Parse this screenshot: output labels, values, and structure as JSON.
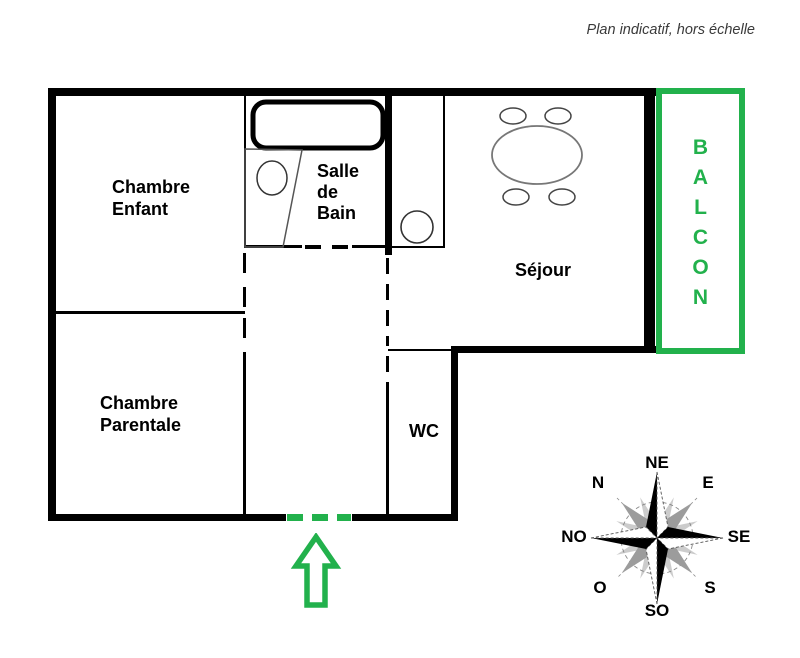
{
  "title": "Plan indicatif, hors échelle",
  "rooms": {
    "chambre_enfant": "Chambre\nEnfant",
    "chambre_parentale": "Chambre\nParentale",
    "salle_de_bain": "Salle\nde\nBain",
    "sejour": "Séjour",
    "wc": "WC"
  },
  "balcony": {
    "name": "BALCON",
    "letters": [
      "B",
      "A",
      "L",
      "C",
      "O",
      "N"
    ]
  },
  "compass": {
    "n": "N",
    "ne": "NE",
    "e": "E",
    "se": "SE",
    "s": "S",
    "so": "SO",
    "o": "O",
    "no": "NO"
  },
  "colors": {
    "accent_green": "#22b14c",
    "wall_black": "#000000",
    "compass_gray": "#9c9c9c",
    "title_gray": "#3a3a3a"
  }
}
